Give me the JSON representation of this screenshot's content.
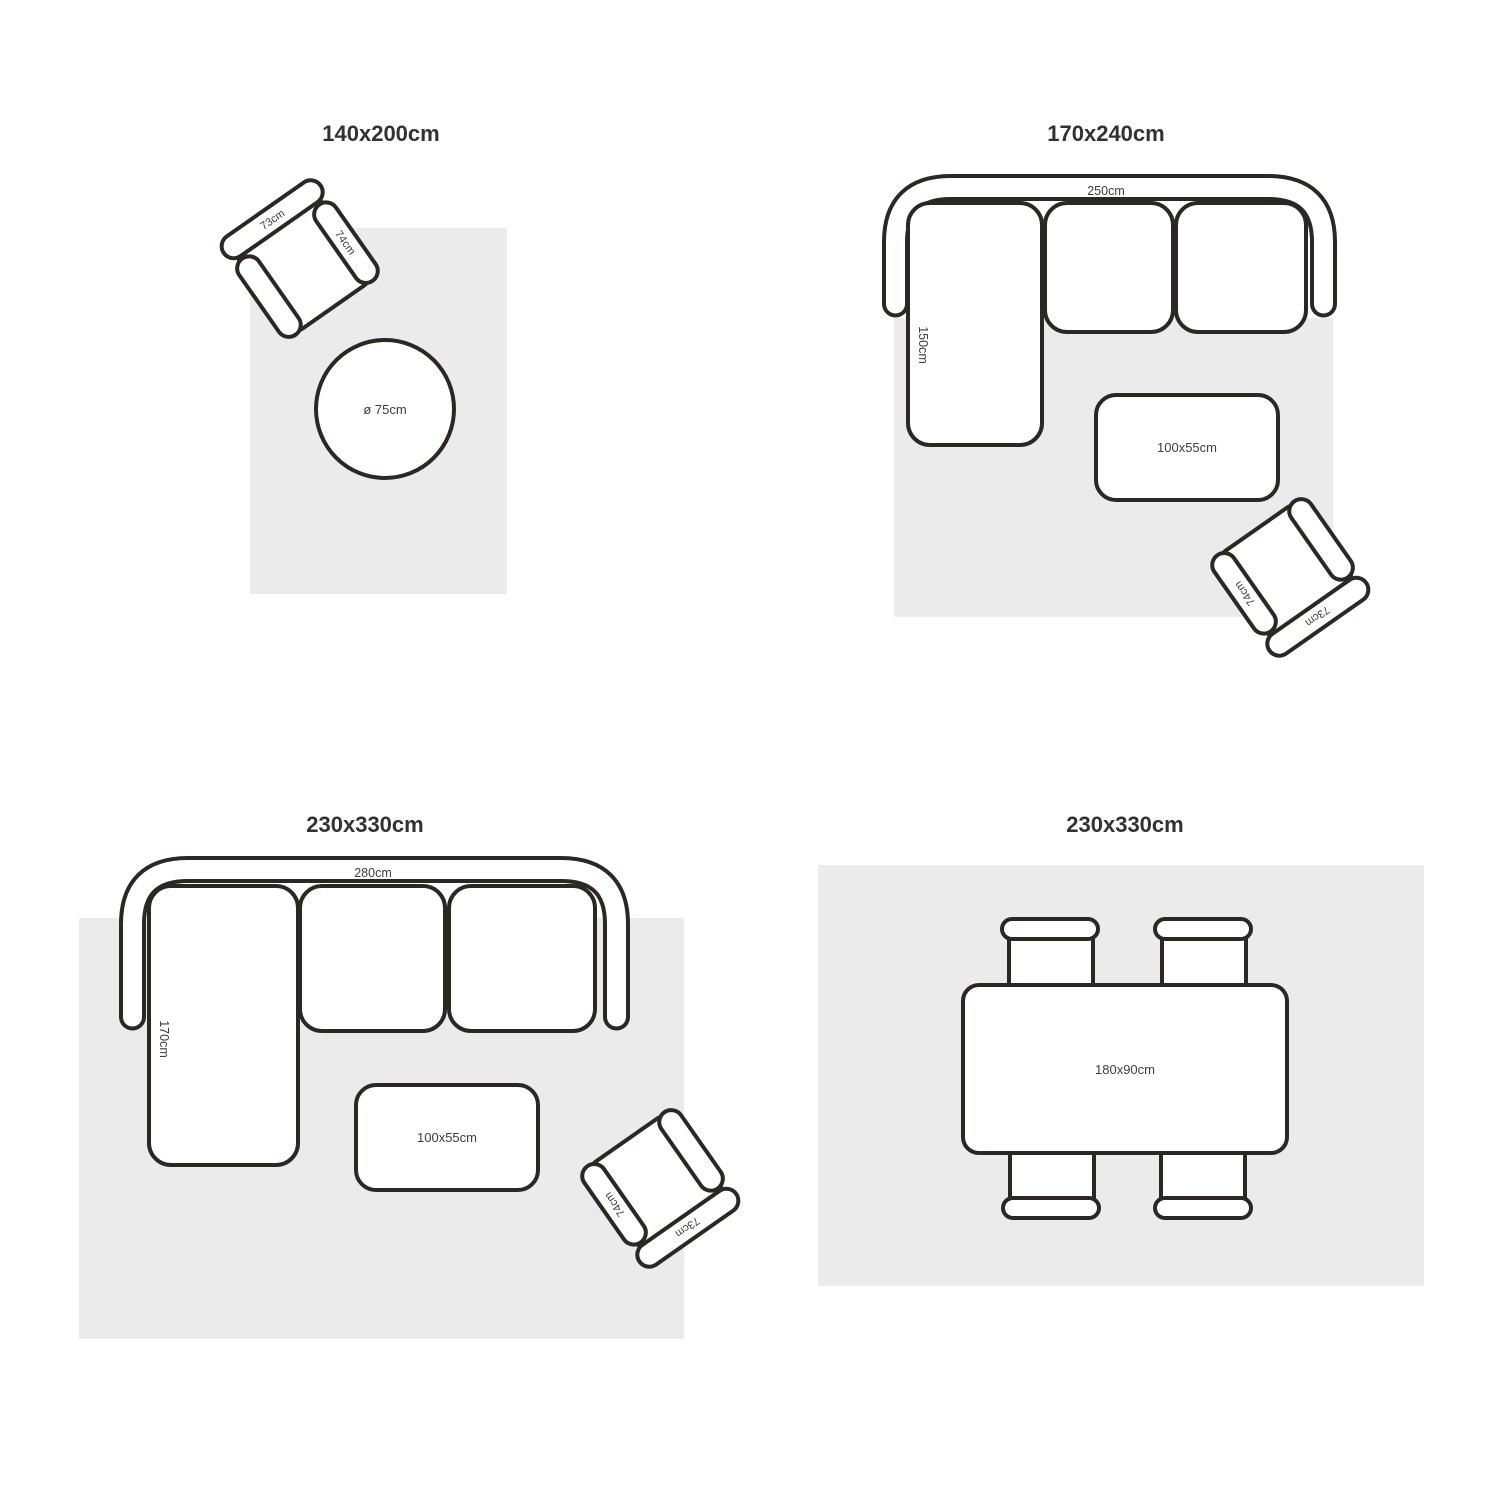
{
  "page": {
    "background_color": "#ffffff",
    "rug_color": "#ebebeb",
    "stroke_color": "#2b2823",
    "title_color": "#323232",
    "label_color": "#3d3d3d"
  },
  "sections": {
    "rug_140x200": {
      "title": "140x200cm",
      "armchair": {
        "width_label": "73cm",
        "depth_label": "74cm"
      },
      "round_table_label": "ø 75cm"
    },
    "rug_170x240": {
      "title": "170x240cm",
      "sofa": {
        "width_label": "250cm",
        "chaise_label": "150cm"
      },
      "coffee_table_label": "100x55cm",
      "armchair": {
        "width_label": "73cm",
        "depth_label": "74cm"
      }
    },
    "rug_230x330_living": {
      "title": "230x330cm",
      "sofa": {
        "width_label": "280cm",
        "chaise_label": "170cm"
      },
      "coffee_table_label": "100x55cm",
      "armchair": {
        "width_label": "73cm",
        "depth_label": "74cm"
      }
    },
    "rug_230x330_dining": {
      "title": "230x330cm",
      "dining_table_label": "180x90cm"
    }
  }
}
